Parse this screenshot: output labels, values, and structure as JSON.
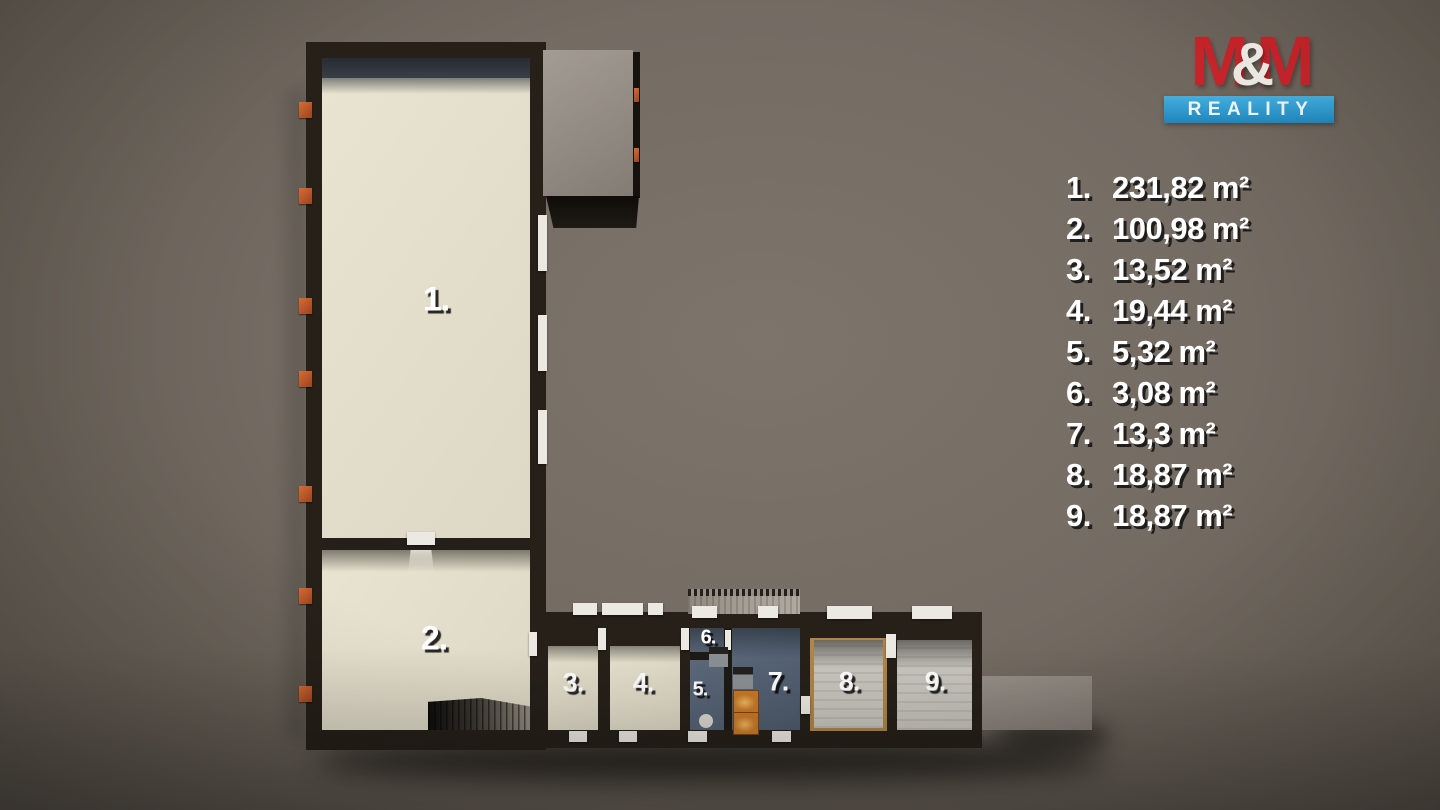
{
  "logo": {
    "m1": "M",
    "amp": "&",
    "m2": "M",
    "banner": "REALITY"
  },
  "legend": {
    "items": [
      {
        "num": "1.",
        "area": "231,82 m²"
      },
      {
        "num": "2.",
        "area": "100,98 m²"
      },
      {
        "num": "3.",
        "area": "13,52 m²"
      },
      {
        "num": "4.",
        "area": "19,44 m²"
      },
      {
        "num": "5.",
        "area": "5,32 m²"
      },
      {
        "num": "6.",
        "area": "3,08 m²"
      },
      {
        "num": "7.",
        "area": "13,3 m²"
      },
      {
        "num": "8.",
        "area": "18,87 m²"
      },
      {
        "num": "9.",
        "area": "18,87 m²"
      }
    ]
  },
  "plan": {
    "room_labels": [
      "1.",
      "2.",
      "3.",
      "4.",
      "5.",
      "6.",
      "7.",
      "8.",
      "9."
    ]
  },
  "colors": {
    "brand_red": "#c8232a",
    "brand_blue": "#2b9fd6",
    "wall_dark": "#262019",
    "floor_cream": "#e4dfcc",
    "floor_blue_gray": "#5a6878",
    "floor_tile_gray": "#c6c3bc",
    "wood_frame": "#b08549",
    "window_orange": "#c75f2b",
    "marker_white": "#ece9e3",
    "background_gray": "#6e675e"
  }
}
